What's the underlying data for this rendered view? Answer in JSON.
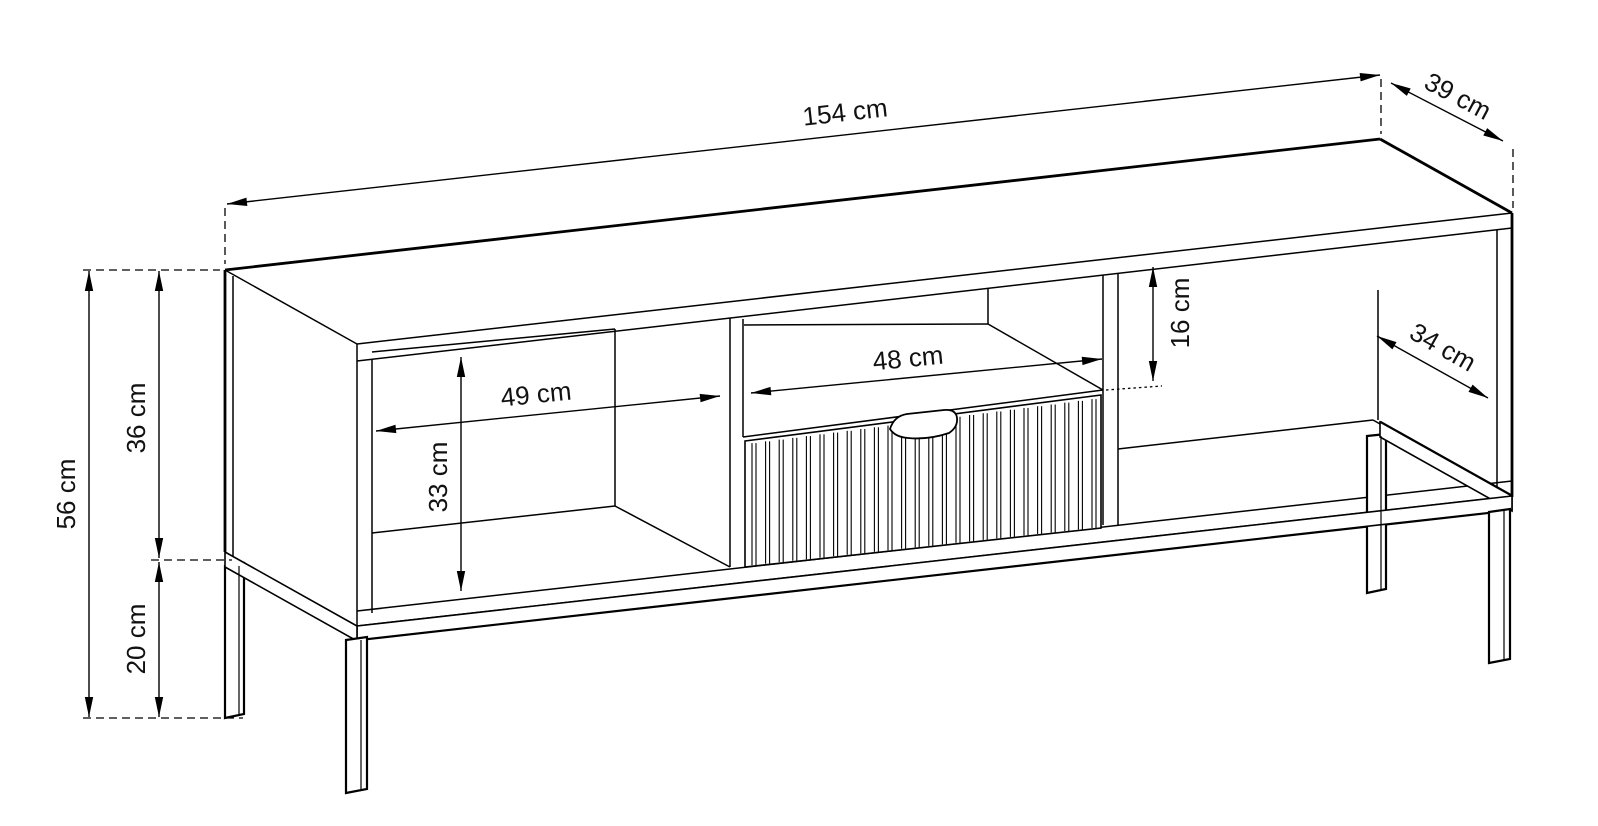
{
  "diagram": {
    "title": "Furniture dimension drawing",
    "subject": "TV stand with fluted drawer, two open compartments and metal leg frame",
    "unit": "cm",
    "canvas": {
      "width": 1598,
      "height": 826,
      "background": "#ffffff",
      "line_color": "#000000",
      "label_color": "#111111",
      "label_font_size": 26
    },
    "dimensions": [
      {
        "name": "overall-width",
        "label": "154 cm",
        "value": 154
      },
      {
        "name": "overall-depth",
        "label": "39 cm",
        "value": 39
      },
      {
        "name": "overall-height",
        "label": "56 cm",
        "value": 56
      },
      {
        "name": "body-height",
        "label": "36 cm",
        "value": 36
      },
      {
        "name": "leg-height",
        "label": "20 cm",
        "value": 20
      },
      {
        "name": "left-compartment-width",
        "label": "49 cm",
        "value": 49
      },
      {
        "name": "left-compartment-height",
        "label": "33 cm",
        "value": 33
      },
      {
        "name": "niche-width",
        "label": "48 cm",
        "value": 48
      },
      {
        "name": "niche-height",
        "label": "16 cm",
        "value": 16
      },
      {
        "name": "right-compartment-depth",
        "label": "34 cm",
        "value": 34
      }
    ],
    "geometry": {
      "thin_lines": [
        [
          225,
          270,
          357,
          344
        ],
        [
          233,
          276,
          233,
          556
        ],
        [
          357,
          344,
          1512,
          213
        ],
        [
          357,
          361,
          1512,
          228
        ],
        [
          357,
          344,
          357,
          626
        ],
        [
          372,
          359,
          372,
          613
        ],
        [
          372,
          352,
          615,
          329
        ],
        [
          615,
          329,
          615,
          506
        ],
        [
          372,
          533,
          615,
          506
        ],
        [
          615,
          506,
          730,
          567
        ],
        [
          730,
          318,
          730,
          567
        ],
        [
          743,
          319,
          743,
          437
        ],
        [
          743,
          437,
          1103,
          390
        ],
        [
          744,
          325,
          988,
          324
        ],
        [
          988,
          289,
          988,
          324
        ],
        [
          988,
          324,
          1103,
          390
        ],
        [
          1103,
          275,
          1103,
          525
        ],
        [
          1118,
          273,
          1118,
          525
        ],
        [
          1118,
          449,
          1373,
          420
        ],
        [
          1373,
          420,
          1497,
          490
        ],
        [
          1378,
          290,
          1378,
          420
        ],
        [
          1497,
          230,
          1497,
          490
        ],
        [
          357,
          611,
          1512,
          481
        ],
        [
          357,
          626,
          1512,
          496
        ]
      ],
      "thick_lines": [
        [
          225,
          270,
          1380,
          139
        ],
        [
          1380,
          139,
          1512,
          213
        ],
        [
          1512,
          213,
          1512,
          497
        ],
        [
          1380,
          422,
          1512,
          496
        ],
        [
          225,
          270,
          225,
          552
        ],
        [
          357,
          640,
          1512,
          510
        ]
      ],
      "back_legs": [
        [
          225,
          566,
          244,
          563,
          244,
          714,
          225,
          718
        ],
        [
          1367,
          436,
          1386,
          434,
          1386,
          589,
          1367,
          593
        ]
      ],
      "rails": [
        [
          1380,
          422,
          1512,
          496,
          1512,
          511,
          1380,
          437
        ],
        [
          357,
          626,
          1512,
          496,
          1512,
          510,
          357,
          640
        ],
        [
          225,
          552,
          357,
          626,
          357,
          641,
          225,
          567
        ]
      ],
      "front_legs": [
        [
          346,
          640,
          367,
          637,
          367,
          789,
          346,
          793
        ],
        [
          1489,
          512,
          1510,
          509,
          1510,
          659,
          1489,
          663
        ]
      ],
      "leg_detail_lines": [
        [
          239,
          566,
          239,
          716
        ],
        [
          361,
          640,
          361,
          791
        ],
        [
          1381,
          436,
          1381,
          591
        ],
        [
          1504,
          510,
          1504,
          661
        ]
      ],
      "drawer": {
        "quad": [
          745,
          441,
          1101,
          395,
          1101,
          528,
          745,
          567
        ],
        "slats": {
          "x_start": 752,
          "x_end": 1092,
          "count": 26,
          "pair_offset": 4,
          "top": {
            "x0": 745,
            "y0": 441,
            "slope": -0.1292
          },
          "bottom": {
            "x0": 745,
            "y0": 567,
            "slope": -0.1096
          }
        },
        "handle_path": "M 890 429 Q 894 416 907 414 L 944 410 Q 956 409 957 418 Q 958 427 949 433 Q 928 440 908 438 Q 895 437 890 429 Z"
      },
      "dashed_lines": [
        [
          225,
          208,
          225,
          264
        ],
        [
          1381,
          79,
          1381,
          134
        ],
        [
          1513,
          149,
          1513,
          208
        ],
        [
          83,
          270,
          220,
          270
        ],
        [
          83,
          718,
          243,
          718
        ],
        [
          151,
          560,
          232,
          560
        ]
      ],
      "dotted_lines": [
        [
          1106,
          390,
          1162,
          386
        ]
      ],
      "dim_arrows": [
        {
          "name": "overall-width",
          "label": "154 cm",
          "x1": 227,
          "y1": 204,
          "x2": 1380,
          "y2": 75,
          "lx": 845,
          "ly": 112,
          "rot": -6.4
        },
        {
          "name": "overall-depth",
          "label": "39 cm",
          "x1": 1391,
          "y1": 83,
          "x2": 1503,
          "y2": 141,
          "lx": 1458,
          "ly": 96,
          "rot": 28
        },
        {
          "name": "overall-height",
          "label": "56 cm",
          "x1": 89,
          "y1": 271,
          "x2": 89,
          "y2": 717,
          "lx": 66,
          "ly": 494,
          "rot": -90
        },
        {
          "name": "body-height",
          "label": "36 cm",
          "x1": 159,
          "y1": 271,
          "x2": 159,
          "y2": 558,
          "lx": 136,
          "ly": 418,
          "rot": -90
        },
        {
          "name": "leg-height",
          "label": "20 cm",
          "x1": 159,
          "y1": 562,
          "x2": 159,
          "y2": 717,
          "lx": 136,
          "ly": 639,
          "rot": -90
        },
        {
          "name": "left-compartment-width",
          "label": "49 cm",
          "x1": 376,
          "y1": 431,
          "x2": 720,
          "y2": 396,
          "lx": 536,
          "ly": 394,
          "rot": -5.8
        },
        {
          "name": "left-compartment-height",
          "label": "33 cm",
          "x1": 461,
          "y1": 357,
          "x2": 461,
          "y2": 591,
          "lx": 438,
          "ly": 477,
          "rot": -90
        },
        {
          "name": "niche-width",
          "label": "48 cm",
          "x1": 751,
          "y1": 393,
          "x2": 1102,
          "y2": 359,
          "lx": 908,
          "ly": 358,
          "rot": -5.6
        },
        {
          "name": "niche-height",
          "label": "16 cm",
          "x1": 1153,
          "y1": 267,
          "x2": 1153,
          "y2": 381,
          "lx": 1180,
          "ly": 313,
          "rot": -90
        },
        {
          "name": "right-compartment-depth",
          "label": "34 cm",
          "x1": 1377,
          "y1": 336,
          "x2": 1488,
          "y2": 398,
          "lx": 1443,
          "ly": 347,
          "rot": 29.5
        }
      ],
      "arrowhead": {
        "length": 20,
        "half_width": 4.2
      }
    }
  }
}
